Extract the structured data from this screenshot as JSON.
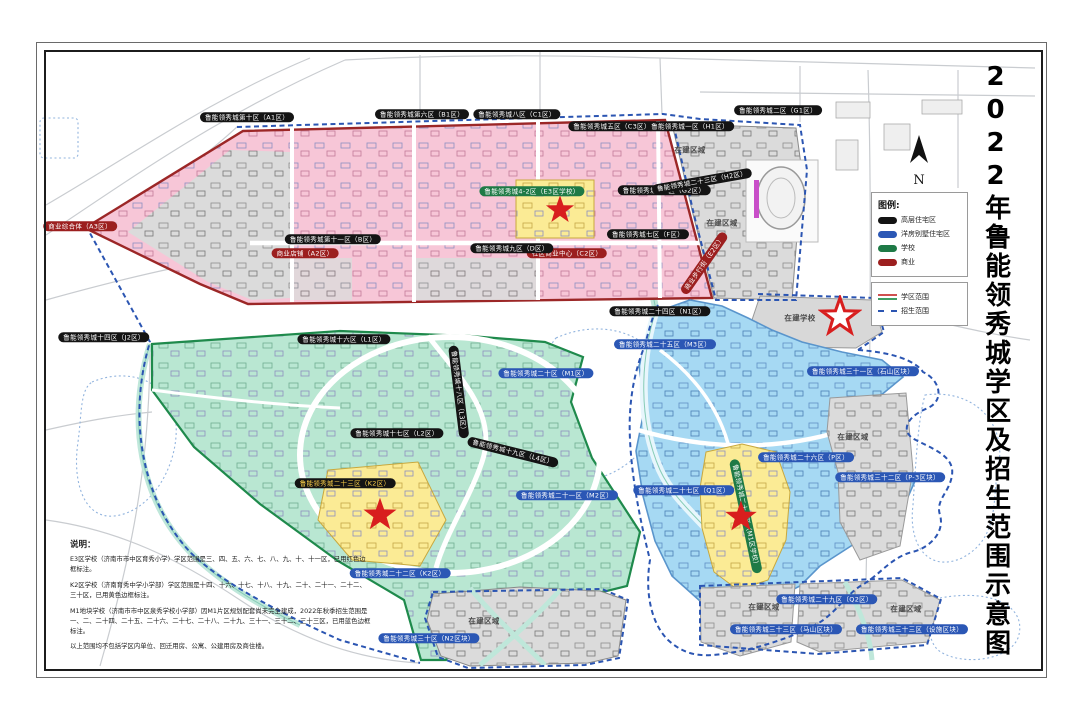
{
  "doc": {
    "title": "2022年鲁能领秀城学区及招生范围示意图"
  },
  "map": {
    "north_label": "N",
    "pill_colors": {
      "black": "#141414",
      "blue": "#2b57b5",
      "green": "#1e7a46",
      "red": "#9c1f1f",
      "yellow_text": "#ffd24a"
    },
    "labels": [
      {
        "t": "鲁能领秀城第十区（A1区）",
        "x": 247,
        "y": 117,
        "c": "black"
      },
      {
        "t": "鲁能领秀城第六区（B1区）",
        "x": 422,
        "y": 114,
        "c": "black"
      },
      {
        "t": "鲁能领秀城八区（C1区）",
        "x": 517,
        "y": 114,
        "c": "black"
      },
      {
        "t": "鲁能领秀城五区（C3区）",
        "x": 612,
        "y": 126,
        "c": "black"
      },
      {
        "t": "鲁能领秀城一区（H1区）",
        "x": 690,
        "y": 126,
        "c": "black"
      },
      {
        "t": "鲁能领秀城二区（G1区）",
        "x": 778,
        "y": 110,
        "c": "black"
      },
      {
        "t": "商业综合体（A3区）",
        "x": 80,
        "y": 226,
        "c": "red"
      },
      {
        "t": "商业店铺（A2区）",
        "x": 305,
        "y": 253,
        "c": "red"
      },
      {
        "t": "社区商业中心（C2区）",
        "x": 567,
        "y": 253,
        "c": "red"
      },
      {
        "t": "鲁能领秀城4-2区（E3区学校）",
        "x": 532,
        "y": 191,
        "c": "green"
      },
      {
        "t": "鲁能领秀城4-1区（G2区）",
        "x": 664,
        "y": 190,
        "c": "black"
      },
      {
        "t": "鲁能领秀城第十一区（B区）",
        "x": 333,
        "y": 239,
        "c": "black"
      },
      {
        "t": "鲁能领秀城九区（D区）",
        "x": 512,
        "y": 248,
        "c": "black"
      },
      {
        "t": "鲁能领秀城七区（F区）",
        "x": 648,
        "y": 234,
        "c": "black"
      },
      {
        "t": "鲁能领秀城二十三区（H2区）",
        "x": 702,
        "y": 181,
        "c": "black",
        "r": -10
      },
      {
        "t": "商业步行街（E2区）",
        "x": 704,
        "y": 263,
        "c": "red",
        "r": -55
      },
      {
        "t": "鲁能领秀城二十四区（N1区）",
        "x": 660,
        "y": 311,
        "c": "black"
      },
      {
        "t": "鲁能领秀城十四区（J2区）",
        "x": 104,
        "y": 337,
        "c": "black"
      },
      {
        "t": "鲁能领秀城十六区（L1区）",
        "x": 344,
        "y": 339,
        "c": "black"
      },
      {
        "t": "鲁能领秀城十七区（L2区）",
        "x": 397,
        "y": 433,
        "c": "black"
      },
      {
        "t": "鲁能领秀城十八区（L3区）",
        "x": 459,
        "y": 392,
        "c": "black",
        "r": 83
      },
      {
        "t": "鲁能领秀城十九区（L4区）",
        "x": 513,
        "y": 452,
        "c": "black",
        "r": 14
      },
      {
        "t": "鲁能领秀城二十区（M1区）",
        "x": 546,
        "y": 373,
        "c": "blue"
      },
      {
        "t": "鲁能领秀城二十三区（K2区）",
        "x": 345,
        "y": 483,
        "c": "black-yellow"
      },
      {
        "t": "鲁能领秀城二十二区（K2区）",
        "x": 400,
        "y": 573,
        "c": "blue"
      },
      {
        "t": "鲁能领秀城二十一区（M2区）",
        "x": 567,
        "y": 495,
        "c": "blue"
      },
      {
        "t": "鲁能领秀城二十五区（M3区）",
        "x": 665,
        "y": 344,
        "c": "blue"
      },
      {
        "t": "鲁能领秀城三十一区（石山区块）",
        "x": 863,
        "y": 371,
        "c": "blue"
      },
      {
        "t": "鲁能领秀城二十六区（P区）",
        "x": 806,
        "y": 457,
        "c": "blue"
      },
      {
        "t": "鲁能领秀城三十二区（P-3区块）",
        "x": 890,
        "y": 477,
        "c": "blue"
      },
      {
        "t": "鲁能领秀城二十七区（Q1区）",
        "x": 684,
        "y": 490,
        "c": "blue"
      },
      {
        "t": "鲁能领秀城二十八区（M1区学校）",
        "x": 746,
        "y": 516,
        "c": "green",
        "r": 78
      },
      {
        "t": "鲁能领秀城二十九区（Q2区）",
        "x": 827,
        "y": 599,
        "c": "blue"
      },
      {
        "t": "鲁能领秀城三十三区（马山区块）",
        "x": 786,
        "y": 629,
        "c": "blue"
      },
      {
        "t": "鲁能领秀城三十三区（设施区块）",
        "x": 912,
        "y": 629,
        "c": "blue"
      },
      {
        "t": "鲁能领秀城三十区（N2区块）",
        "x": 429,
        "y": 638,
        "c": "blue"
      },
      {
        "t": "在建区域",
        "x": 690,
        "y": 150,
        "c": "gray"
      },
      {
        "t": "在建区域",
        "x": 722,
        "y": 223,
        "c": "gray"
      },
      {
        "t": "在建学校",
        "x": 800,
        "y": 318,
        "c": "gray"
      },
      {
        "t": "在建区域",
        "x": 853,
        "y": 437,
        "c": "gray"
      },
      {
        "t": "在建区域",
        "x": 484,
        "y": 621,
        "c": "gray"
      },
      {
        "t": "在建区域",
        "x": 764,
        "y": 607,
        "c": "gray"
      },
      {
        "t": "在建区域",
        "x": 906,
        "y": 609,
        "c": "gray"
      }
    ],
    "stars": [
      {
        "x": 560,
        "y": 212,
        "s": 34,
        "v": "filled"
      },
      {
        "x": 380,
        "y": 517,
        "s": 40,
        "v": "filled"
      },
      {
        "x": 741,
        "y": 519,
        "s": 38,
        "v": "filled"
      },
      {
        "x": 840,
        "y": 319,
        "s": 44,
        "v": "outline"
      }
    ],
    "star_color": "#d81e1e"
  },
  "legend": {
    "title": "图例:",
    "items": [
      {
        "label": "高层住宅区",
        "color": "#141414"
      },
      {
        "label": "洋房别墅住宅区",
        "color": "#2b57b5"
      },
      {
        "label": "学校",
        "color": "#1e7a46"
      },
      {
        "label": "商业",
        "color": "#9c1f1f"
      }
    ],
    "lines": [
      {
        "label": "学区范围",
        "color_top": "#d05050",
        "color_bottom": "#3f9e63"
      },
      {
        "label": "招生范围",
        "color": "#2b55b2"
      }
    ]
  },
  "notes": {
    "heading": "说明：",
    "p1": "E3区学校（济南市市中区育秀小学）学区范围是三、四、五、六、七、八、九、十、十一区，已用红色边框标注。",
    "p2": "K2区学校（济南育秀中学小学部）学区范围是十四、十六、十七、十八、十九、二十、二十一、二十二、三十区，已用黄色边框标注。",
    "p3": "M1地块学校（济南市市中区泉秀学校小学部）因M1片区规划配套尚未完全建成，2022年秋季招生范围是一、二、二十四、二十五、二十六、二十七、二十八、二十九、三十一、三十二、三十三区，已用蓝色边框标注。",
    "p4": "以上范围均不包括学区内单位、回迁用房、公寓、公建用房及商住楼。"
  }
}
